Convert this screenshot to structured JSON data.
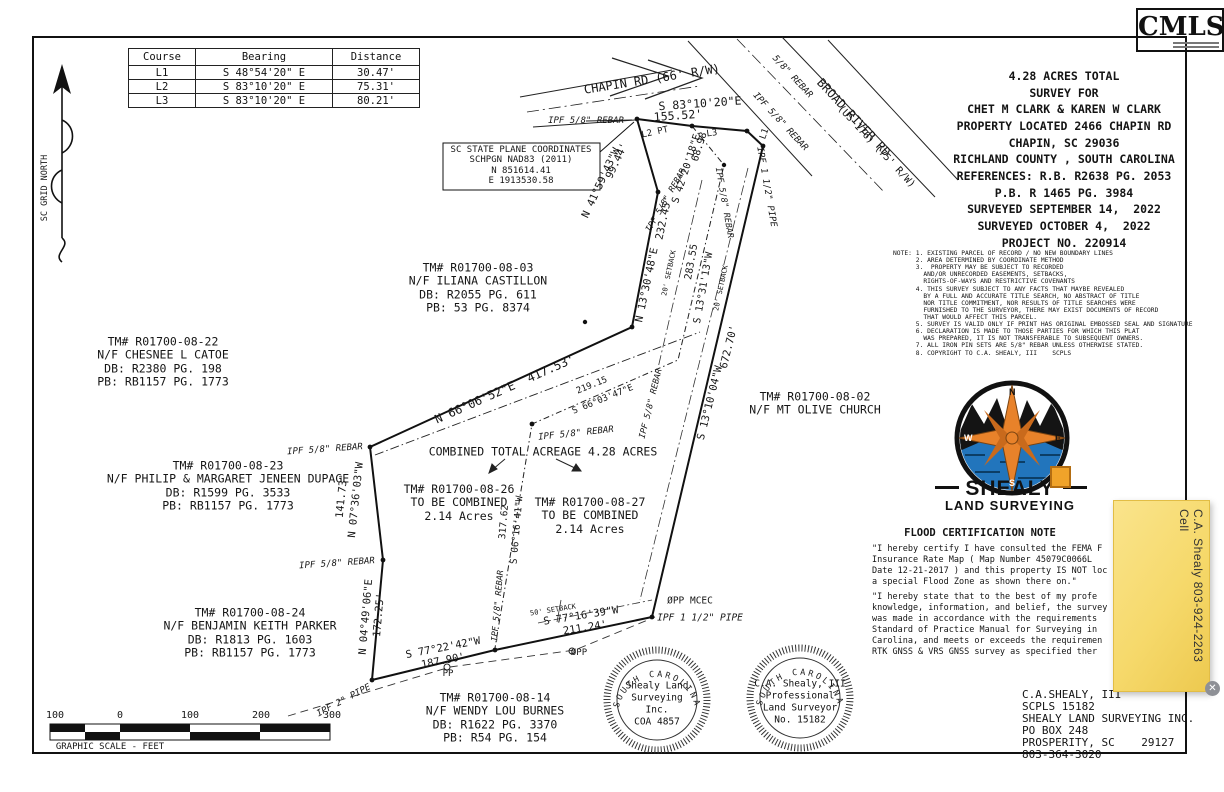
{
  "colors": {
    "ink": "#111111",
    "accent_orange": "#E8822A",
    "water_blue": "#2275BC",
    "sticky_yellow": "#F6D96B"
  },
  "cmls": {
    "label": "CMLS"
  },
  "course_table": {
    "headers": [
      "Course",
      "Bearing",
      "Distance"
    ],
    "rows": [
      [
        "L1",
        "S 48°54'20\" E",
        "30.47'"
      ],
      [
        "L2",
        "S 83°10'20\" E",
        "75.31'"
      ],
      [
        "L3",
        "S 83°10'20\" E",
        "80.21'"
      ]
    ]
  },
  "title_block": {
    "lines": [
      "4.28 ACRES TOTAL",
      "SURVEY FOR",
      "CHET M CLARK & KAREN W CLARK",
      "PROPERTY LOCATED 2466 CHAPIN RD",
      "CHAPIN, SC 29036",
      "RICHLAND COUNTY , SOUTH CAROLINA",
      "REFERENCES: R.B. R2638 PG. 2053",
      "P.B. R 1465 PG. 3984",
      "SURVEYED SEPTEMBER 14,  2022",
      "SURVEYED OCTOBER 4,  2022",
      "PROJECT NO. 220914"
    ]
  },
  "notes": {
    "lines": [
      "NOTE: 1. EXISTING PARCEL OF RECORD / NO NEW BOUNDARY LINES",
      "      2. AREA DETERMINED BY COORDINATE METHOD",
      "      3.  PROPERTY MAY BE SUBJECT TO RECORDED",
      "        AND/OR UNRECORDED EASEMENTS, SETBACKS,",
      "        RIGHTS-OF-WAYS AND RESTRICTIVE COVENANTS",
      "      4. THIS SURVEY SUBJECT TO ANY FACTS THAT MAYBE REVEALED",
      "        BY A FULL AND ACCURATE TITLE SEARCH, NO ABSTRACT OF TITLE",
      "        NOR TITLE COMMITMENT, NOR RESULTS OF TITLE SEARCHES WERE",
      "        FURNISHED TO THE SURVEYOR, THERE MAY EXIST DOCUMENTS OF RECORD",
      "        THAT WOULD AFFECT THIS PARCEL.",
      "      5. SURVEY IS VALID ONLY IF PRINT HAS ORIGINAL EMBOSSED SEAL AND SIGNATURE",
      "      6. DECLARATION IS MADE TO THOSE PARTIES FOR WHICH THIS PLAT",
      "        WAS PREPARED, IT IS NOT TRANSFERABLE TO SUBSEQUENT OWNERS.",
      "      7. ALL IRON PIN SETS ARE 5/8\" REBAR UNLESS OTHERWISE STATED.",
      "      8. COPYRIGHT TO C.A. SHEALY, III    SCPLS"
    ]
  },
  "logo": {
    "name": "SHEALY",
    "subtitle": "LAND SURVEYING",
    "compass": {
      "n": "N",
      "e": "E",
      "s": "S",
      "w": "W"
    }
  },
  "flood": {
    "title": "FLOOD CERTIFICATION NOTE",
    "para1": [
      "\"I hereby certify I have consulted the FEMA F",
      "Insurance Rate Map ( Map Number 45079C0066L",
      "Date 12-21-2017 ) and this property IS NOT loc",
      "a special Flood Zone as shown there on.\""
    ],
    "para2": [
      "\"I hereby state that to the best of my profe",
      "knowledge, information, and belief, the survey",
      "was made in accordance with the requirements",
      "Standard of Practice Manual for Surveying in",
      "Carolina, and meets or exceeds the requiremen",
      "RTK GNSS & VRS GNSS survey as specified ther"
    ]
  },
  "seals": [
    {
      "arc": "SOUTH CAROLINA",
      "lines": [
        "Shealy Land",
        "Surveying",
        "Inc.",
        "COA 4857"
      ]
    },
    {
      "arc": "SOUTH CAROLINA",
      "lines": [
        "C.A. Shealy, III",
        "Professional",
        "Land Surveyor",
        "No. 15182"
      ]
    }
  ],
  "contact": {
    "lines": [
      "C.A.SHEALY, III",
      "SCPLS 15182",
      "SHEALY LAND SURVEYING INC.",
      "PO BOX 248",
      "PROSPERITY, SC    29127",
      "803-364-3020"
    ]
  },
  "sticky_note": {
    "text": "C.A. Shealy 803-924-2263 Cell",
    "close_glyph": "✕"
  },
  "plat_labels": [
    {
      "t": "CHAPIN RD (66' R/W)",
      "x": 652,
      "y": 80,
      "r": -9,
      "s": 12,
      "n": "chapin-rd-label"
    },
    {
      "t": "S 83°10'20\"E",
      "x": 700,
      "y": 104,
      "r": -4,
      "s": 11.5
    },
    {
      "t": "155.52'",
      "x": 678,
      "y": 116,
      "r": -4,
      "s": 11.5
    },
    {
      "t": "IPF 5/8\" REBAR",
      "x": 586,
      "y": 121,
      "s": 9,
      "i": 1
    },
    {
      "t": "L2 PT",
      "x": 655,
      "y": 133,
      "r": -12,
      "s": 9
    },
    {
      "t": "L3",
      "x": 712,
      "y": 134,
      "r": -8,
      "s": 9
    },
    {
      "t": "L1",
      "x": 765,
      "y": 134,
      "r": -70,
      "s": 9
    },
    {
      "t": "5/8\" REBAR",
      "x": 792,
      "y": 77,
      "r": 47,
      "s": 9,
      "i": 1
    },
    {
      "t": "IPF 5/8\" REBAR",
      "x": 780,
      "y": 122,
      "r": 47,
      "s": 9,
      "i": 1
    },
    {
      "t": "BROAD RIVER RD",
      "x": 853,
      "y": 118,
      "r": 47,
      "s": 12,
      "n": "broad-river-rd-label"
    },
    {
      "t": "(US 176) (75' R/W)",
      "x": 876,
      "y": 147,
      "r": 47,
      "s": 10
    },
    {
      "t": "IPF 1 1/2\" PIPE",
      "x": 766,
      "y": 187,
      "r": 80,
      "s": 9,
      "i": 1
    },
    {
      "t": "99.44'",
      "x": 617,
      "y": 161,
      "r": -65,
      "s": 10.5
    },
    {
      "t": "N 41°59'43\"W",
      "x": 601,
      "y": 183,
      "r": -65,
      "s": 10.5
    },
    {
      "t": "68.98",
      "x": 700,
      "y": 147,
      "r": -72,
      "s": 10
    },
    {
      "t": "S 42°20'18\"E",
      "x": 687,
      "y": 169,
      "r": -72,
      "s": 10
    },
    {
      "t": "IPF 5/8\" REBAR",
      "x": 667,
      "y": 201,
      "r": -60,
      "s": 8.5,
      "i": 1
    },
    {
      "t": "IPF 5/8\" REBAR",
      "x": 723,
      "y": 203,
      "r": 80,
      "s": 8.5,
      "i": 1
    },
    {
      "t": "232.45'",
      "x": 664,
      "y": 218,
      "r": -78,
      "s": 10.5
    },
    {
      "t": "N 13°30'48\"E",
      "x": 647,
      "y": 285,
      "r": -78,
      "s": 10.5
    },
    {
      "t": "20' SETBACK",
      "x": 669,
      "y": 273,
      "r": -78,
      "s": 7
    },
    {
      "t": "20' SETBACK",
      "x": 721,
      "y": 288,
      "r": -78,
      "s": 7
    },
    {
      "t": "283.55",
      "x": 692,
      "y": 262,
      "r": -80,
      "s": 10
    },
    {
      "t": "S 13°31'13\"W",
      "x": 704,
      "y": 288,
      "r": -80,
      "s": 10
    },
    {
      "t": "672.70'",
      "x": 729,
      "y": 347,
      "r": -76,
      "s": 10.5
    },
    {
      "t": "S 13°10'04\"W",
      "x": 710,
      "y": 403,
      "r": -76,
      "s": 10.5
    },
    {
      "t": "IPF 5/8\" REBAR",
      "x": 652,
      "y": 404,
      "r": -76,
      "s": 8.5,
      "i": 1
    },
    {
      "t": "TM# R01700-08-02\nN/F MT OLIVE CHURCH",
      "x": 815,
      "y": 404,
      "s": 11.5,
      "n": "parcel-02-label"
    },
    {
      "t": "N 66°06'52\"E  417.53'",
      "x": 505,
      "y": 390,
      "r": -24,
      "s": 12
    },
    {
      "t": "219.15",
      "x": 592,
      "y": 386,
      "r": -22,
      "s": 9
    },
    {
      "t": "S 66°03'47\"E",
      "x": 603,
      "y": 400,
      "r": -22,
      "s": 9
    },
    {
      "t": "IPF 5/8\" REBAR",
      "x": 576,
      "y": 434,
      "r": -6,
      "s": 9,
      "i": 1
    },
    {
      "t": "COMBINED TOTAL ACREAGE 4.28 ACRES",
      "x": 543,
      "y": 452,
      "s": 11.5,
      "n": "combined-acreage-label"
    },
    {
      "t": "TM# R01700-08-26\nTO BE COMBINED\n2.14 Acres",
      "x": 459,
      "y": 503,
      "s": 11.5,
      "n": "parcel-26-label"
    },
    {
      "t": "TM# R01700-08-27\nTO BE COMBINED\n2.14 Acres",
      "x": 590,
      "y": 516,
      "s": 11.5,
      "n": "parcel-27-label"
    },
    {
      "t": "IPF 5/8\" REBAR",
      "x": 325,
      "y": 450,
      "r": -4,
      "s": 9,
      "i": 1
    },
    {
      "t": "141.73'",
      "x": 342,
      "y": 496,
      "r": -84,
      "s": 10.5
    },
    {
      "t": "N 07°36'03\"W",
      "x": 356,
      "y": 500,
      "r": -84,
      "s": 10.5
    },
    {
      "t": "IPF 5/8\" REBAR",
      "x": 337,
      "y": 564,
      "r": -4,
      "s": 9,
      "i": 1
    },
    {
      "t": "N 04°49'06\"E",
      "x": 366,
      "y": 617,
      "r": -85,
      "s": 10.5
    },
    {
      "t": "172.25'",
      "x": 379,
      "y": 615,
      "r": -85,
      "s": 10.5
    },
    {
      "t": "TM# R01700-08-22\nN/F CHESNEE L CATOE\nDB: R2380 PG. 198\nPB: RB1157 PG. 1773",
      "x": 163,
      "y": 362,
      "s": 11.5,
      "n": "parcel-22-label"
    },
    {
      "t": "TM# R01700-08-23\nN/F PHILIP & MARGARET JENEEN DUPAGE\nDB: R1599 PG. 3533\nPB: RB1157 PG. 1773",
      "x": 228,
      "y": 486,
      "s": 11.5,
      "n": "parcel-23-label"
    },
    {
      "t": "TM# R01700-08-24\nN/F BENJAMIN KEITH PARKER\nDB: R1813 PG. 1603\nPB: RB1157 PG. 1773",
      "x": 250,
      "y": 633,
      "s": 11.5,
      "n": "parcel-24-label"
    },
    {
      "t": "TM# R01700-08-14\nN/F WENDY LOU BURNES\nDB: R1622 PG. 3370\nPB: R54 PG. 154",
      "x": 495,
      "y": 718,
      "s": 11.5,
      "n": "parcel-14-label"
    },
    {
      "t": "TM# R01700-08-03\nN/F ILIANA CASTILLON\nDB: R2055 PG. 611\nPB: 53 PG. 8374",
      "x": 478,
      "y": 288,
      "s": 11.5,
      "n": "parcel-03-label"
    },
    {
      "t": "SC STATE PLANE COORDINATES\nSCHPGN NAD83 (2011)\nN 851614.41\nE 1913530.58",
      "x": 521,
      "y": 166,
      "s": 9,
      "n": "state-plane-coordinates"
    },
    {
      "t": "IPF 2\" PIPE",
      "x": 344,
      "y": 701,
      "r": -28,
      "s": 9,
      "i": 1
    },
    {
      "t": "S 77°22'42\"W",
      "x": 443,
      "y": 648,
      "r": -11,
      "s": 10.5
    },
    {
      "t": "187.90'",
      "x": 443,
      "y": 661,
      "r": -11,
      "s": 10.5
    },
    {
      "t": "S 77°16'39\"W",
      "x": 581,
      "y": 616,
      "r": -9,
      "s": 10.5
    },
    {
      "t": "211.24'",
      "x": 585,
      "y": 628,
      "r": -9,
      "s": 10.5
    },
    {
      "t": "50' SETBACK",
      "x": 553,
      "y": 610,
      "r": -9,
      "s": 7
    },
    {
      "t": "IPF 5/8\" REBAR",
      "x": 499,
      "y": 606,
      "r": -85,
      "s": 8.5,
      "i": 1
    },
    {
      "t": "317.62",
      "x": 504,
      "y": 522,
      "r": -85,
      "s": 9.5
    },
    {
      "t": "S 06°16'41\"W",
      "x": 517,
      "y": 530,
      "r": -85,
      "s": 9.5
    },
    {
      "t": "ØPP MCEC",
      "x": 690,
      "y": 601,
      "s": 9.5
    },
    {
      "t": "IPF 1 1/2\" PIPE",
      "x": 700,
      "y": 618,
      "s": 9.5,
      "i": 1
    },
    {
      "t": "PP",
      "x": 448,
      "y": 674,
      "s": 9
    },
    {
      "t": "ØPP",
      "x": 579,
      "y": 653,
      "s": 9
    },
    {
      "t": "SC GRID NORTH",
      "x": 46,
      "y": 188,
      "r": -90,
      "s": 8.5,
      "n": "sc-grid-north-label"
    },
    {
      "t": "100",
      "x": 55,
      "y": 716,
      "s": 10,
      "n": "scale-number"
    },
    {
      "t": "0",
      "x": 120,
      "y": 716,
      "s": 10,
      "n": "scale-number"
    },
    {
      "t": "100",
      "x": 190,
      "y": 716,
      "s": 10,
      "n": "scale-number"
    },
    {
      "t": "200",
      "x": 261,
      "y": 716,
      "s": 10,
      "n": "scale-number"
    },
    {
      "t": "300",
      "x": 332,
      "y": 716,
      "s": 10,
      "n": "scale-number"
    },
    {
      "t": "GRAPHIC SCALE - FEET",
      "x": 110,
      "y": 747,
      "s": 9,
      "n": "graphic-scale-caption"
    }
  ]
}
